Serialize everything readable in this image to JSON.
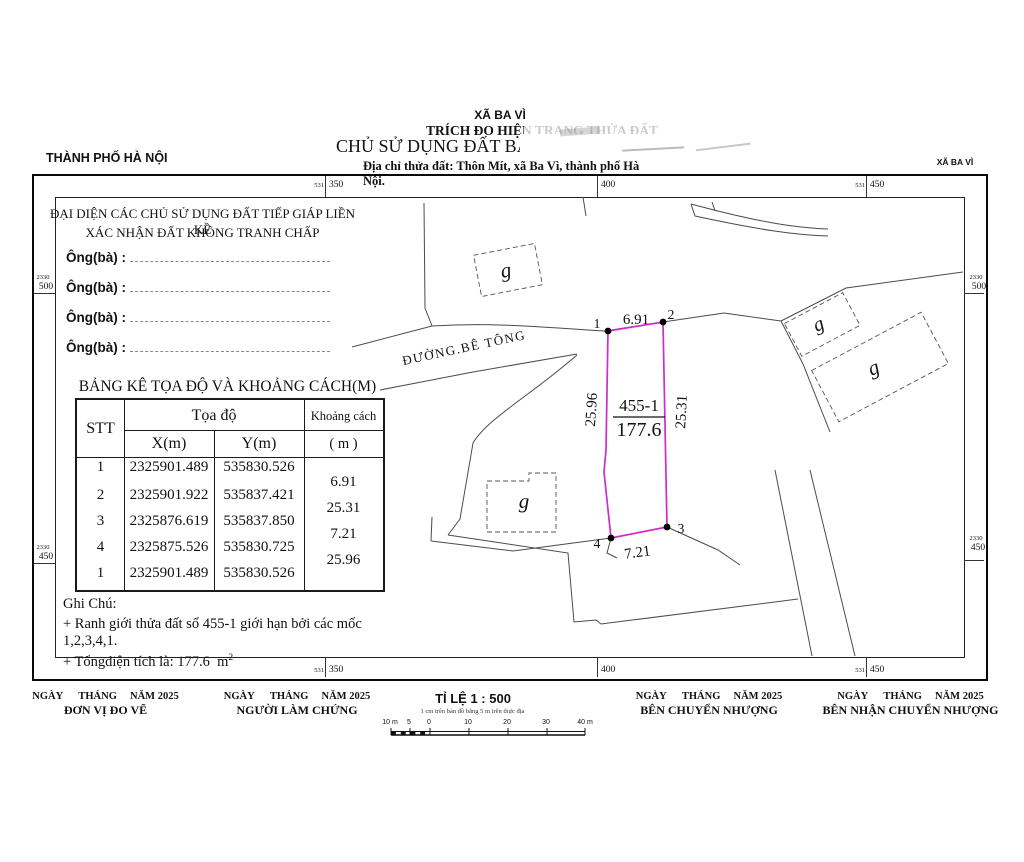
{
  "header": {
    "province": "THÀNH PHỐ HÀ NỘI",
    "commune_top": "XÃ BA VÌ",
    "doc_type": "TRÍCH ĐO HIỆN TRẠNG THỬA ĐẤT",
    "owner": "CHỦ SỬ DỤNG ĐẤT BÀ: 1",
    "address": "Địa chỉ thửa đất: Thôn Mít, xã Ba Vì, thành phố Hà Nội.",
    "commune_right": "XÃ BA VÌ"
  },
  "grid": {
    "top_left_small": "531",
    "top_left_big": "350",
    "top_mid_big": "400",
    "top_right_small": "531",
    "top_right_big": "450",
    "bottom_left_small": "531",
    "bottom_left_big": "350",
    "bottom_mid_big": "400",
    "bottom_right_small": "531",
    "bottom_right_big": "450",
    "left_upper_small": "2330",
    "left_upper_big": "500",
    "left_lower_small": "2330",
    "left_lower_big": "450",
    "right_upper_small": "2330",
    "right_upper_big": "500",
    "right_lower_small": "2330",
    "right_lower_big": "450"
  },
  "confirmation": {
    "title1": "ĐẠI DIỆN CÁC CHỦ SỬ DỤNG ĐẤT TIẾP GIÁP LIỀN KỀ",
    "title2": "XÁC NHẬN ĐẤT KHÔNG TRANH CHẤP",
    "rows": [
      "Ông(bà) :",
      "Ông(bà) :",
      "Ông(bà) :",
      "Ông(bà) :"
    ]
  },
  "table": {
    "title": "BẢNG KÊ TỌA ĐỘ VÀ KHOẢNG CÁCH(M)",
    "headers": {
      "stt": "STT",
      "toado": "Tọa độ",
      "x": "X(m)",
      "y": "Y(m)",
      "kc1": "Khoảng cách",
      "kc2": "( m )"
    },
    "rows": [
      {
        "stt": "1",
        "x": "2325901.489",
        "y": "535830.526"
      },
      {
        "stt": "2",
        "x": "2325901.922",
        "y": "535837.421"
      },
      {
        "stt": "3",
        "x": "2325876.619",
        "y": "535837.850"
      },
      {
        "stt": "4",
        "x": "2325875.526",
        "y": "535830.725"
      },
      {
        "stt": "1",
        "x": "2325901.489",
        "y": "535830.526"
      }
    ],
    "distances": [
      "6.91",
      "25.31",
      "7.21",
      "25.96"
    ]
  },
  "notes": {
    "title": "Ghi Chú:",
    "line1": "+ Ranh giới thửa đất số 455-1 giới hạn bởi các mốc  1,2,3,4,1.",
    "line2": "+ Tổngdiện tích là: 177.6",
    "line2_unit": "m",
    "line2_sup": "2"
  },
  "map": {
    "road_label": "ĐƯỜNG.BÊ TÔNG",
    "building_label": "g",
    "parcel": {
      "id": "455-1",
      "area": "177.6",
      "v1": "1",
      "v2": "2",
      "v3": "3",
      "v4": "4",
      "edge_top": "6.91",
      "edge_right": "25.31",
      "edge_bottom": "7.21",
      "edge_left": "25.96"
    },
    "boundary_color": "#d02ad0"
  },
  "footer": {
    "date1": "NGÀY      THÁNG     NĂM 2025",
    "role1": "ĐƠN VỊ ĐO VẼ",
    "date2": "NGÀY      THÁNG     NĂM 2025",
    "role2": "NGƯỜI LÀM CHỨNG",
    "date3": "NGÀY      THÁNG     NĂM 2025",
    "role3": "BÊN CHUYỂN NHƯỢNG",
    "date4": "NGÀY      THÁNG     NĂM 2025",
    "role4": "BÊN NHẬN CHUYỂN NHƯỢNG",
    "scale_title": "TỈ LỆ 1 : 500",
    "scale_subtitle": "1 cm trên bản đồ bằng 5 m trên thực địa",
    "scale_ticks": [
      "10 m",
      "5",
      "0",
      "10",
      "20",
      "30",
      "40 m"
    ]
  }
}
